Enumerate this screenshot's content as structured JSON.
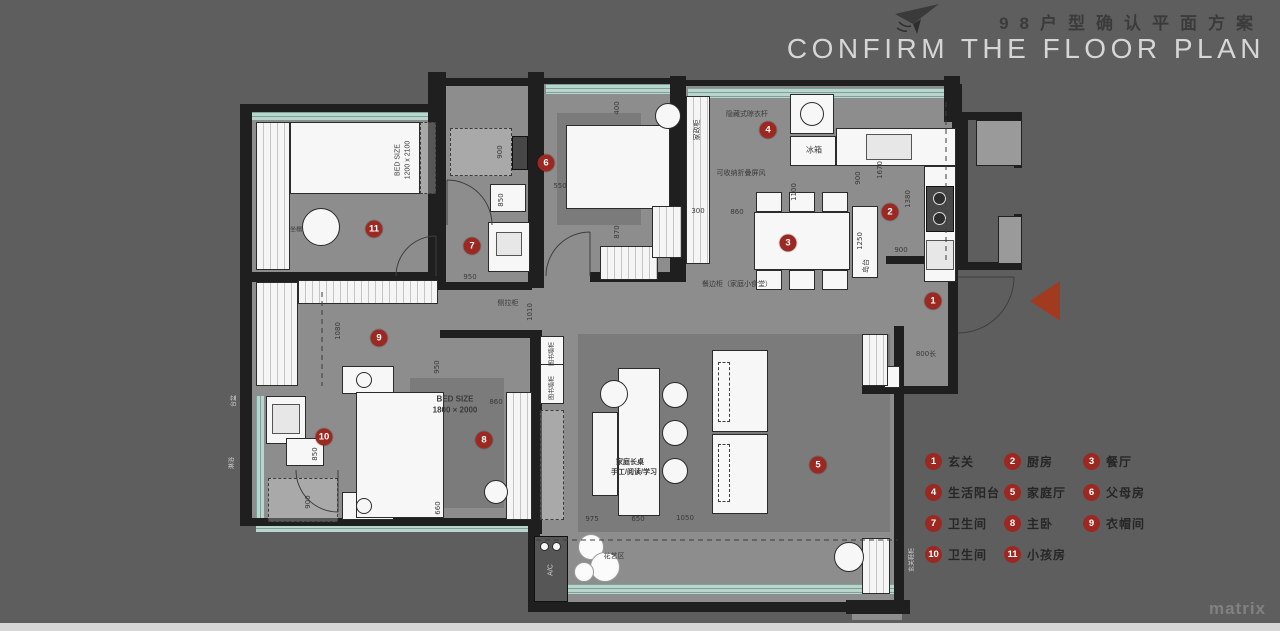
{
  "title": {
    "zh": "98户型确认平面方案",
    "en": "CONFIRM THE FLOOR PLAN",
    "plane_icon": "paper-plane-icon"
  },
  "watermark": "matrix",
  "colors": {
    "background": "#5e5e5e",
    "wall": "#1f1f1f",
    "floor": "#8d8d8d",
    "rug": "#7b7b7b",
    "window_glazing": "#aac9c0",
    "marker_red": "#9c2822",
    "arrow_red": "#a23a20",
    "title_en": "#d6d6d6",
    "title_zh": "#3b3b3b"
  },
  "legend": {
    "items": [
      {
        "num": "1",
        "label": "玄关"
      },
      {
        "num": "2",
        "label": "厨房"
      },
      {
        "num": "3",
        "label": "餐厅"
      },
      {
        "num": "4",
        "label": "生活阳台"
      },
      {
        "num": "5",
        "label": "家庭厅"
      },
      {
        "num": "6",
        "label": "父母房"
      },
      {
        "num": "7",
        "label": "卫生间"
      },
      {
        "num": "8",
        "label": "主卧"
      },
      {
        "num": "9",
        "label": "衣帽间"
      },
      {
        "num": "10",
        "label": "卫生间"
      },
      {
        "num": "11",
        "label": "小孩房"
      }
    ]
  },
  "plan": {
    "entry_arrow_icon": "entry-direction-arrow-icon",
    "markers": [
      {
        "num": "1",
        "x": 933,
        "y": 301
      },
      {
        "num": "2",
        "x": 890,
        "y": 212
      },
      {
        "num": "3",
        "x": 788,
        "y": 243
      },
      {
        "num": "4",
        "x": 768,
        "y": 130
      },
      {
        "num": "5",
        "x": 818,
        "y": 465
      },
      {
        "num": "6",
        "x": 546,
        "y": 163
      },
      {
        "num": "7",
        "x": 472,
        "y": 246
      },
      {
        "num": "8",
        "x": 484,
        "y": 440
      },
      {
        "num": "9",
        "x": 379,
        "y": 338
      },
      {
        "num": "10",
        "x": 324,
        "y": 437
      },
      {
        "num": "11",
        "x": 374,
        "y": 229
      }
    ],
    "dimensions": [
      {
        "t": "900",
        "x": 500,
        "y": 152,
        "v": 1
      },
      {
        "t": "850",
        "x": 501,
        "y": 200,
        "v": 1
      },
      {
        "t": "950",
        "x": 470,
        "y": 277,
        "v": 0
      },
      {
        "t": "550",
        "x": 560,
        "y": 186,
        "v": 0
      },
      {
        "t": "400",
        "x": 617,
        "y": 108,
        "v": 1
      },
      {
        "t": "870",
        "x": 617,
        "y": 232,
        "v": 1
      },
      {
        "t": "300",
        "x": 698,
        "y": 211,
        "v": 0
      },
      {
        "t": "860",
        "x": 737,
        "y": 212,
        "v": 0
      },
      {
        "t": "1100",
        "x": 794,
        "y": 192,
        "v": 1
      },
      {
        "t": "900",
        "x": 858,
        "y": 178,
        "v": 1
      },
      {
        "t": "1670",
        "x": 880,
        "y": 170,
        "v": 1
      },
      {
        "t": "1380",
        "x": 908,
        "y": 199,
        "v": 1
      },
      {
        "t": "1250",
        "x": 860,
        "y": 241,
        "v": 1
      },
      {
        "t": "900",
        "x": 901,
        "y": 250,
        "v": 0
      },
      {
        "t": "800长",
        "x": 926,
        "y": 354,
        "v": 0
      },
      {
        "t": "1080",
        "x": 338,
        "y": 331,
        "v": 1
      },
      {
        "t": "950",
        "x": 437,
        "y": 367,
        "v": 1
      },
      {
        "t": "860",
        "x": 496,
        "y": 402,
        "v": 0
      },
      {
        "t": "660",
        "x": 438,
        "y": 508,
        "v": 1
      },
      {
        "t": "900",
        "x": 308,
        "y": 502,
        "v": 1
      },
      {
        "t": "850",
        "x": 315,
        "y": 454,
        "v": 1
      },
      {
        "t": "975",
        "x": 592,
        "y": 519,
        "v": 0
      },
      {
        "t": "650",
        "x": 638,
        "y": 519,
        "v": 0
      },
      {
        "t": "1050",
        "x": 685,
        "y": 518,
        "v": 0
      },
      {
        "t": "1010",
        "x": 530,
        "y": 312,
        "v": 1
      }
    ],
    "labels": [
      {
        "t": "BED SIZE",
        "x": 398,
        "y": 160,
        "v": 1,
        "s": 7
      },
      {
        "t": "1200 x 2100",
        "x": 408,
        "y": 160,
        "v": 1,
        "s": 7
      },
      {
        "t": "BED SIZE",
        "x": 455,
        "y": 399,
        "v": 0,
        "s": 8,
        "b": 1
      },
      {
        "t": "1800 × 2000",
        "x": 455,
        "y": 410,
        "v": 0,
        "s": 8,
        "b": 1
      },
      {
        "t": "冰箱",
        "x": 814,
        "y": 150,
        "v": 0,
        "s": 8
      },
      {
        "t": "家政柜",
        "x": 697,
        "y": 130,
        "v": 1,
        "s": 7
      },
      {
        "t": "隐藏式晾衣杆",
        "x": 747,
        "y": 114,
        "v": 0,
        "s": 7
      },
      {
        "t": "可收纳折叠屏风",
        "x": 741,
        "y": 173,
        "v": 0,
        "s": 7
      },
      {
        "t": "餐边柜（家庭小食堂）",
        "x": 737,
        "y": 284,
        "v": 0,
        "s": 7
      },
      {
        "t": "侧拉柜",
        "x": 508,
        "y": 303,
        "v": 0,
        "s": 7
      },
      {
        "t": "家庭长桌",
        "x": 630,
        "y": 462,
        "v": 0,
        "s": 7,
        "b": 1
      },
      {
        "t": "手工/阅读/学习",
        "x": 634,
        "y": 472,
        "v": 0,
        "s": 7,
        "b": 1
      },
      {
        "t": "花艺区",
        "x": 614,
        "y": 556,
        "v": 0,
        "s": 7
      },
      {
        "t": "图书墙柜",
        "x": 551,
        "y": 354,
        "v": 1,
        "s": 6
      },
      {
        "t": "图书墙柜",
        "x": 551,
        "y": 388,
        "v": 1,
        "s": 6
      },
      {
        "t": "A/C",
        "x": 551,
        "y": 570,
        "v": 1,
        "s": 7,
        "light": 1
      },
      {
        "t": "坐榻",
        "x": 296,
        "y": 229,
        "v": 0,
        "s": 6
      },
      {
        "t": "岛台",
        "x": 866,
        "y": 266,
        "v": 1,
        "s": 7
      },
      {
        "t": "玄关鞋柜",
        "x": 911,
        "y": 560,
        "v": 1,
        "s": 6,
        "light": 1
      },
      {
        "t": "台盆",
        "x": 233,
        "y": 401,
        "v": 1,
        "s": 6,
        "light": 1
      },
      {
        "t": "淋浴",
        "x": 231,
        "y": 463,
        "v": 1,
        "s": 6,
        "light": 1
      }
    ]
  }
}
